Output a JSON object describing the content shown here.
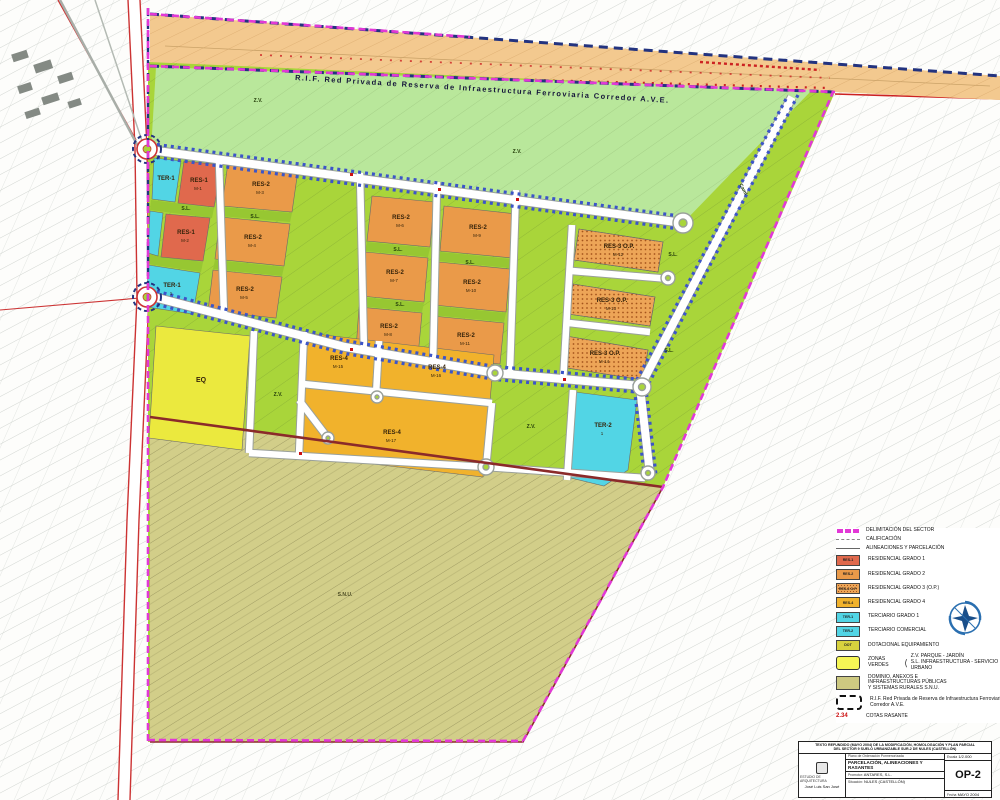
{
  "band": {
    "rif_label": "R.I.F. Red Privada de Reserva de Infraestructura Ferroviaria Corredor A.V.E."
  },
  "map": {
    "zone_labels": {
      "zv": "Z.V.",
      "sl": "S.L.",
      "snu": "S.N.U.",
      "eq": "EQ",
      "cami": "Camí"
    },
    "parcels": [
      {
        "code": "TER-1",
        "id": ""
      },
      {
        "code": "RES-1",
        "id": "M-1"
      },
      {
        "code": "RES-1",
        "id": "M-2"
      },
      {
        "code": "TER-1",
        "id": "1"
      },
      {
        "code": "RES-2",
        "id": "M-3"
      },
      {
        "code": "RES-2",
        "id": "M-4"
      },
      {
        "code": "RES-2",
        "id": "M-5"
      },
      {
        "code": "RES-2",
        "id": "M-6"
      },
      {
        "code": "RES-2",
        "id": "M-7"
      },
      {
        "code": "RES-2",
        "id": "M-8"
      },
      {
        "code": "RES-2",
        "id": "M-9"
      },
      {
        "code": "RES-2",
        "id": "M-10"
      },
      {
        "code": "RES-2",
        "id": "M-11"
      },
      {
        "code": "RES-3 O.P.",
        "id": "M-12"
      },
      {
        "code": "RES-3 O.P.",
        "id": "M-13"
      },
      {
        "code": "RES-3 O.P.",
        "id": "M-14"
      },
      {
        "code": "RES-4",
        "id": "M-15"
      },
      {
        "code": "RES-4",
        "id": "M-16"
      },
      {
        "code": "RES-4",
        "id": "M-17"
      },
      {
        "code": "EQ",
        "id": ""
      },
      {
        "code": "TER-2",
        "id": "1"
      }
    ]
  },
  "legend": {
    "items": [
      {
        "label": "DELIMITACIÓN DEL SECTOR"
      },
      {
        "label": "CALIFICACIÓN"
      },
      {
        "label": "ALINEACIONES Y PARCELACIÓN"
      },
      {
        "chip": "RES-1",
        "label": "RESIDENCIAL GRADO 1"
      },
      {
        "chip": "RES-2",
        "label": "RESIDENCIAL GRADO 2"
      },
      {
        "chip": "RES-3 O.P.",
        "label": "RESIDENCIAL GRADO 3 (O.P.)"
      },
      {
        "chip": "RES-4",
        "label": "RESIDENCIAL GRADO 4"
      },
      {
        "chip": "TER-1",
        "label": "TERCIARIO GRADO 1"
      },
      {
        "chip": "TER-2",
        "label": "TERCIARIO COMERCIAL"
      },
      {
        "chip": "DOT",
        "label": "DOTACIONAL EQUIPAMIENTO"
      },
      {
        "label": "ZONAS VERDES",
        "sub1": "Z.V. PARQUE - JARDÍN",
        "sub2": "S.L. INFRAESTRUCTURA - SERVICIO URBANO"
      },
      {
        "line1": "DOMINIO, ANEXOS E",
        "line2": "INFRAESTRUCTURAS PÚBLICAS",
        "line3": "Y SISTEMAS RURALES S.N.U."
      },
      {
        "label": "R.I.F. Red Privada de Reserva de Infraestructura Ferroviaria Corredor A.V.E."
      },
      {
        "value": "2.34",
        "label": "COTAS RASANTE"
      }
    ]
  },
  "titleblock": {
    "project_line1": "TEXTO REFUNDIDO (MAYO 2004) DE LA MODIFICACIÓN, HOMOLOGACIÓN Y PLAN PARCIAL",
    "project_line2": "DEL SECTOR 9 SUELO URBANIZABLE SUR-2 DE NULES (CASTELLÓN)",
    "firm": "ESTUDIO DE ARQUITECTURA",
    "architect": "José Luis San José",
    "doc_label": "Plano de Ordenación Pormenorizada",
    "sheet_title": "PARCELACIÓN, ALINEACIONES Y RASANTES",
    "promoter_label": "Promotor:",
    "promoter": "ANTARES, S.L.",
    "location_label": "Situación:",
    "location": "NULES (CASTELLÓN)",
    "scale_label": "Escala",
    "scale": "1/2.000",
    "date_label": "Fecha",
    "date": "MAYO 2004",
    "sheet_no": "OP-2"
  }
}
